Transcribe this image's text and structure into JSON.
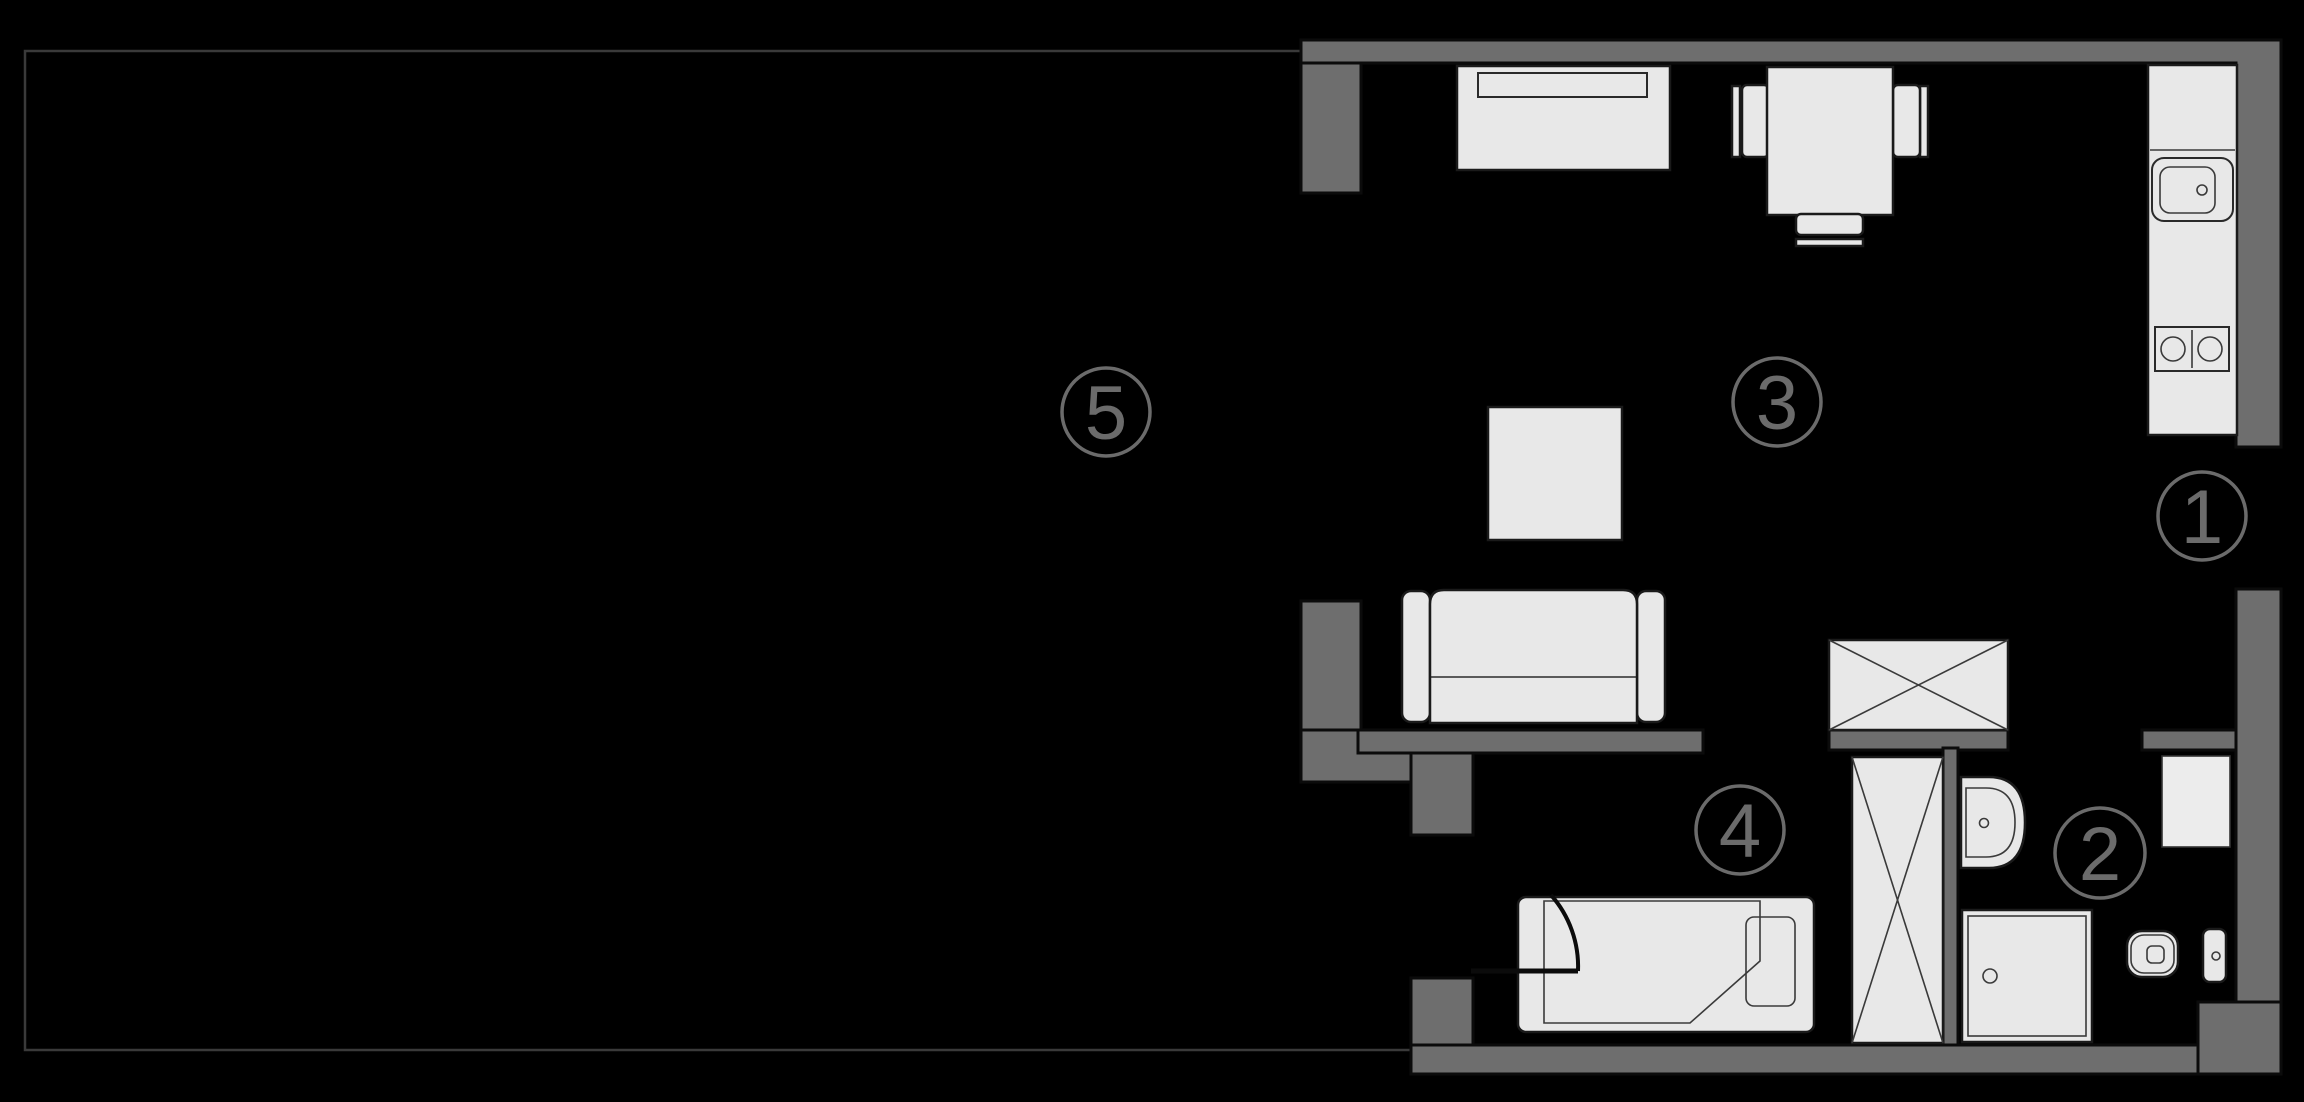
{
  "plan": {
    "title": "apartment-floor-plan",
    "width": 2304,
    "height": 1102
  },
  "colors": {
    "background": "#000000",
    "wall_fill": "#6e6e6e",
    "wall_outline": "#0b0b0b",
    "furniture_fill": "#e8e8e8",
    "furniture_outline": "#1a1a1a",
    "label_gray": "#6b6b6b",
    "terrace_outline": "#3a3a3a"
  },
  "room_labels": [
    {
      "label": "1",
      "cx": 2202,
      "cy": 516,
      "r": 44
    },
    {
      "label": "2",
      "cx": 2100,
      "cy": 853,
      "r": 45
    },
    {
      "label": "3",
      "cx": 1777,
      "cy": 402,
      "r": 44
    },
    {
      "label": "4",
      "cx": 1740,
      "cy": 830,
      "r": 44
    },
    {
      "label": "5",
      "cx": 1106,
      "cy": 412,
      "r": 44
    }
  ]
}
